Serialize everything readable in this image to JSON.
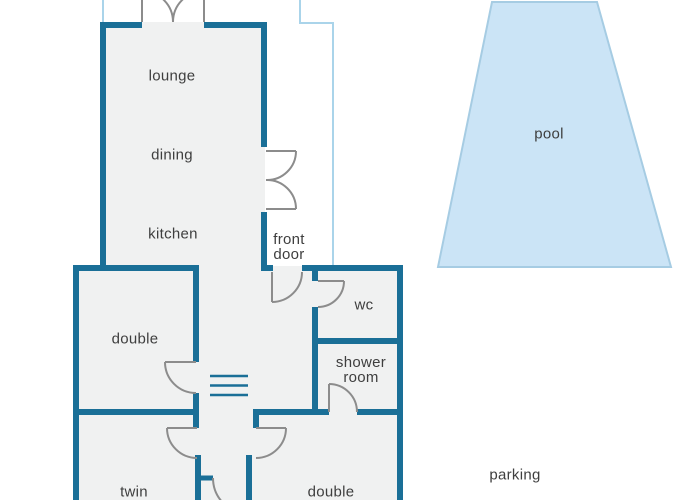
{
  "title": "holiday house floor plan",
  "colors": {
    "background": "#ffffff",
    "wall": "#1a6f97",
    "door": "#8c8c8c",
    "floor": "#f0f1f1",
    "boundary": "#aad4ea",
    "pool_fill": "#cbe4f6",
    "pool_border": "#a6cce3",
    "text": "#3e3e3e"
  },
  "floor_plan": {
    "type": "floor-plan",
    "labels": [
      {
        "id": "lounge",
        "lines": [
          "lounge"
        ],
        "x": 172,
        "y": 76
      },
      {
        "id": "dining",
        "lines": [
          "dining"
        ],
        "x": 172,
        "y": 155
      },
      {
        "id": "kitchen",
        "lines": [
          "kitchen"
        ],
        "x": 173,
        "y": 234
      },
      {
        "id": "front-door",
        "lines": [
          "front",
          "door"
        ],
        "x": 289,
        "y": 247
      },
      {
        "id": "wc",
        "lines": [
          "wc"
        ],
        "x": 364,
        "y": 305
      },
      {
        "id": "shower-room",
        "lines": [
          "shower",
          "room"
        ],
        "x": 361,
        "y": 370
      },
      {
        "id": "double-bedroom",
        "lines": [
          "double"
        ],
        "x": 135,
        "y": 339
      },
      {
        "id": "twin-bedroom",
        "lines": [
          "twin"
        ],
        "x": 134,
        "y": 492
      },
      {
        "id": "double-bedroom-2",
        "lines": [
          "double"
        ],
        "x": 331,
        "y": 492
      },
      {
        "id": "pool",
        "lines": [
          "pool"
        ],
        "x": 549,
        "y": 134
      },
      {
        "id": "parking",
        "lines": [
          "parking"
        ],
        "x": 515,
        "y": 475
      }
    ],
    "features": [
      "lounge-dining-kitchen open plan",
      "french doors top",
      "french doors to terrace",
      "front door",
      "wc door",
      "shower room door",
      "double bedroom door",
      "twin bedroom door",
      "double bedroom 2 door",
      "rear corridor door",
      "stairs symbol",
      "pool",
      "parking",
      "terrace boundary"
    ]
  }
}
